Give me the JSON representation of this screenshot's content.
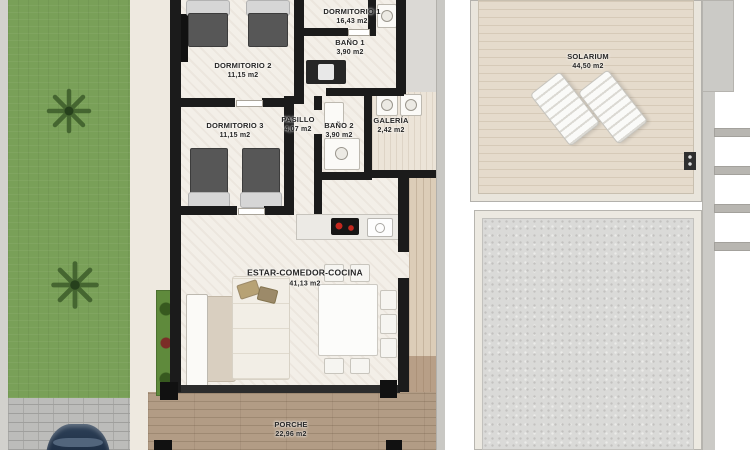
{
  "plan": {
    "rooms": [
      {
        "id": "dormitorio-1",
        "name": "DORMITORIO 1",
        "area": "16,43 m2"
      },
      {
        "id": "bano-1",
        "name": "BAÑO 1",
        "area": "3,90 m2"
      },
      {
        "id": "dormitorio-2",
        "name": "DORMITORIO 2",
        "area": "11,15 m2"
      },
      {
        "id": "dormitorio-3",
        "name": "DORMITORIO 3",
        "area": "11,15 m2"
      },
      {
        "id": "pasillo",
        "name": "PASILLO",
        "area": "4,07 m2"
      },
      {
        "id": "bano-2",
        "name": "BAÑO 2",
        "area": "3,90 m2"
      },
      {
        "id": "galeria",
        "name": "GALERÍA",
        "area": "2,42 m2"
      },
      {
        "id": "estar",
        "name": "ESTAR-COMEDOR-COCINA",
        "area": "41,13 m2"
      },
      {
        "id": "porche",
        "name": "PORCHE",
        "area": "22,96 m2"
      },
      {
        "id": "solarium",
        "name": "SOLARIUM",
        "area": "44,50 m2"
      }
    ],
    "objects": [
      "garden-lawn",
      "palm-tree",
      "driveway-pavers",
      "parked-car",
      "perimeter-wall",
      "single-bed",
      "wardrobe",
      "washbasin-vanity",
      "toilet",
      "shower",
      "washing-machine",
      "kitchen-counter",
      "cooktop",
      "kitchen-sink",
      "l-shaped-sofa",
      "sideboard",
      "dining-table",
      "dining-chair",
      "planter-strip",
      "porch-pillar",
      "sun-lounger",
      "roof-hatch",
      "stair-rungs",
      "gravel-plot",
      "side-terrace",
      "glazed-wall"
    ],
    "colors": {
      "walls": "#1b1b1b",
      "grass": "#79a058",
      "interior_floor": "#f3efe8",
      "porch_deck": "#b29c85",
      "solarium_floor": "#e5dbcc",
      "plot_gravel": "#dadad8",
      "driveway": "#bcbcba",
      "car": "#24374f",
      "planter": "#5f8a3c",
      "cooktop_burners": "#c3271e"
    }
  }
}
